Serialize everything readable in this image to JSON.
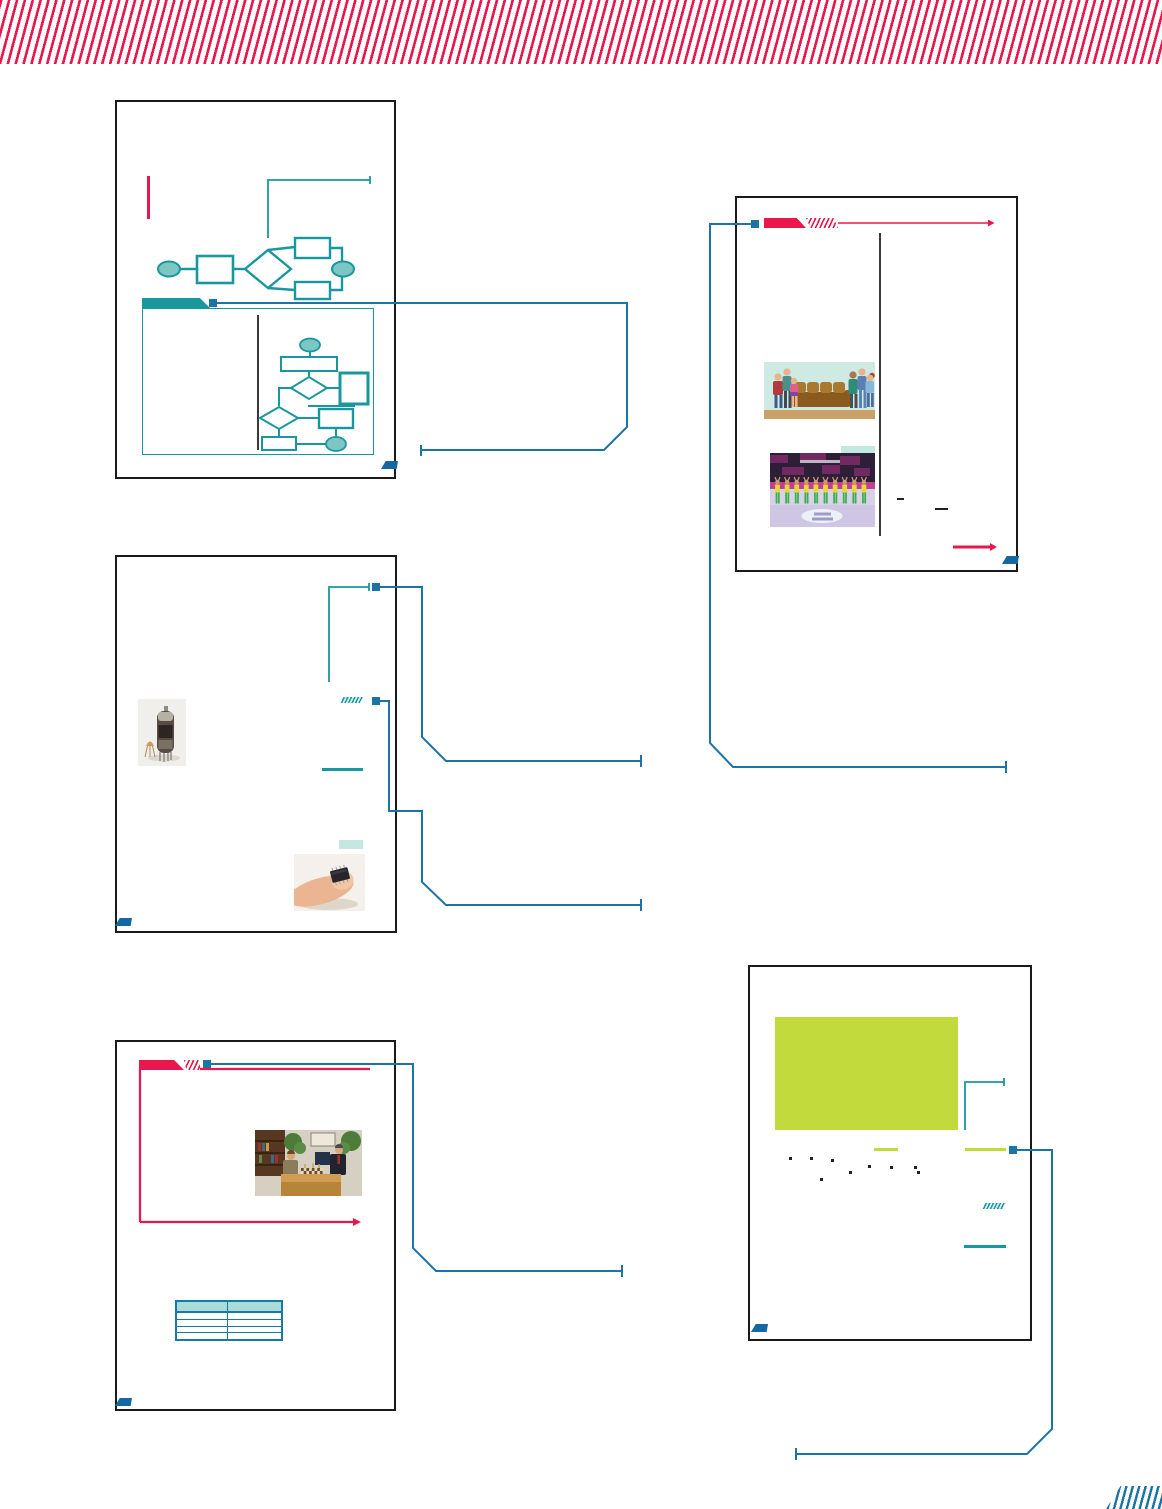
{
  "document": {
    "kind": "textbook-design-layout-spread",
    "text_content": "none — graphic layout preview only",
    "decorations": {
      "top_band": "crimson diagonal stripe band",
      "bottom_right_corner": "blue diagonal stripe block"
    }
  },
  "colors": {
    "crimson": "#e8184d",
    "teal": "#18989e",
    "teal_fill": "#7cc6c3",
    "blue": "#1c73a6",
    "dark_blue": "#1467a2",
    "light_teal": "#c3e8e2",
    "chartreuse": "#c3da3d",
    "page_border": "#1a1a1a",
    "divider": "#3a3a3a",
    "table_header": "#a9dbd8",
    "table_border": "#1779a6",
    "stripe_blue": "#1c73a6"
  },
  "pages": [
    {
      "id": 1,
      "position": "top-left",
      "contents": [
        "red-accent-rule",
        "teal-callout-bracket",
        "simple-flowchart",
        "teal-banner-tab",
        "detail-panel-with-flowchart"
      ],
      "marker": "bottom-right"
    },
    {
      "id": 2,
      "position": "top-right",
      "contents": [
        "red-banner-header",
        "family-sofa-illustration",
        "highlight-rule",
        "sports-team-photo",
        "red-underline"
      ],
      "marker": "bottom-right"
    },
    {
      "id": 3,
      "position": "middle-left",
      "contents": [
        "teal-callout-bracket",
        "vacuum-tube-photo",
        "teal-hatch-tab",
        "teal-rule",
        "highlight-rule",
        "microchip-on-finger-photo"
      ],
      "marker": "bottom-left"
    },
    {
      "id": 4,
      "position": "bottom-left",
      "contents": [
        "red-banner-header",
        "red-outline-bracket",
        "chess-match-photo",
        "two-column-table"
      ],
      "marker": "bottom-left"
    },
    {
      "id": 5,
      "position": "bottom-right",
      "contents": [
        "green-panel",
        "teal-callout-bracket",
        "chartreuse-rules",
        "teal-hatch-tab",
        "teal-rule"
      ],
      "marker": "bottom-left"
    }
  ],
  "table": {
    "columns": 2,
    "rows": 4,
    "header_filled": true
  },
  "flowcharts": {
    "simple": {
      "nodes": [
        "start-oval",
        "process-rect",
        "decision-diamond",
        "branch-rect-top",
        "branch-rect-bottom",
        "end-oval"
      ]
    },
    "detailed": {
      "nodes": [
        "start-oval",
        "process-rect",
        "decision-diamond-1",
        "process-square",
        "decision-diamond-2",
        "process-rect-2",
        "process-rect-3",
        "end-oval"
      ]
    }
  },
  "images": {
    "family_sofa": "cartoon family standing beside a brown sofa",
    "sports_team": "team in yellow-green uniforms lined up on indoor court",
    "vacuum_tube": "vacuum tube beside small transistor",
    "microchip_finger": "microchip resting on a fingertip",
    "chess_match": "two men playing chess at a table"
  },
  "connectors": {
    "blue_callouts": 6,
    "style": "square start node, elbow route with 45-degree bend, bar end tick"
  }
}
